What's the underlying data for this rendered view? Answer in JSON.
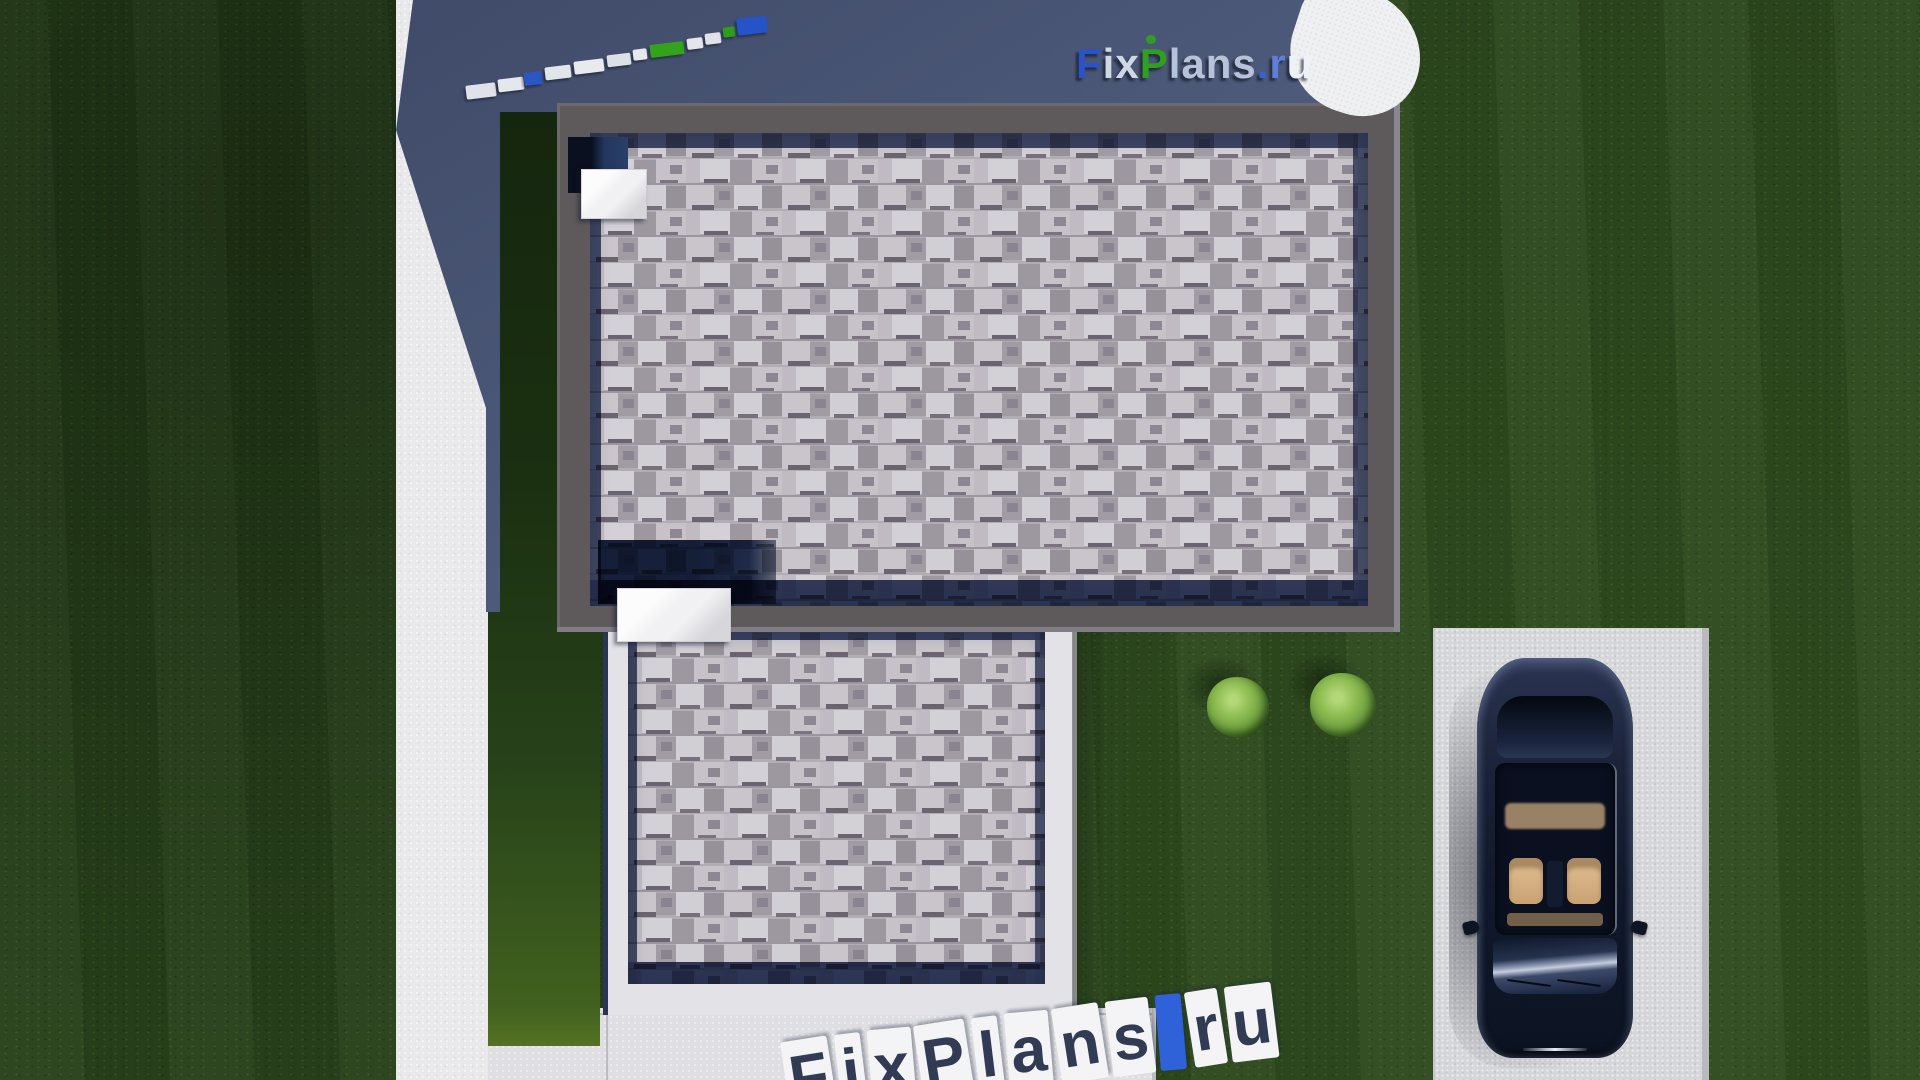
{
  "brand": "FixPlans.ru",
  "watermarks": {
    "logo_top_right": {
      "text": "FixPlans.ru",
      "letters": [
        {
          "ch": "F",
          "color": "#2b53c6"
        },
        {
          "ch": "i",
          "color": "#cfd6e4"
        },
        {
          "ch": "x",
          "color": "#cfd6e4"
        },
        {
          "ch": "P",
          "color": "#2f9e21"
        },
        {
          "ch": "l",
          "color": "#b6c1da"
        },
        {
          "ch": "a",
          "color": "#b6c1da"
        },
        {
          "ch": "n",
          "color": "#b6c1da"
        },
        {
          "ch": "s",
          "color": "#b6c1da"
        },
        {
          "ch": ".",
          "color": "#3a62cf"
        },
        {
          "ch": "r",
          "color": "#5e7ed8"
        },
        {
          "ch": "u",
          "color": "#eef1f7"
        }
      ],
      "accent_dot_color": "#2f9e21",
      "splash_color": "#eef0f1"
    },
    "stamp_bottom": {
      "text": "FixPlans.ru",
      "chip_color": "#f4f4f6",
      "text_color": "#323b54",
      "dot_color": "#2f62d8",
      "angle_deg": -7
    },
    "stone_logo_walkway": {
      "note": "brand logo rendered as stepping stones on shadowed terrace",
      "stones": [
        {
          "x": 466,
          "y": 84,
          "w": 30,
          "h": 14,
          "color": "#dfe2e8"
        },
        {
          "x": 498,
          "y": 78,
          "w": 26,
          "h": 13,
          "color": "#e4e7ec"
        },
        {
          "x": 524,
          "y": 72,
          "w": 18,
          "h": 13,
          "color": "#2b56c4"
        },
        {
          "x": 545,
          "y": 66,
          "w": 26,
          "h": 13,
          "color": "#e2e5ea"
        },
        {
          "x": 574,
          "y": 60,
          "w": 30,
          "h": 13,
          "color": "#e8eaee"
        },
        {
          "x": 607,
          "y": 54,
          "w": 24,
          "h": 12,
          "color": "#dde0e6"
        },
        {
          "x": 633,
          "y": 49,
          "w": 14,
          "h": 11,
          "color": "#e6e8ec"
        },
        {
          "x": 650,
          "y": 43,
          "w": 34,
          "h": 13,
          "color": "#33a31e"
        },
        {
          "x": 687,
          "y": 38,
          "w": 16,
          "h": 11,
          "color": "#e3e6ea"
        },
        {
          "x": 705,
          "y": 33,
          "w": 16,
          "h": 11,
          "color": "#dfe2e8"
        },
        {
          "x": 723,
          "y": 27,
          "w": 12,
          "h": 10,
          "color": "#2f9c1c"
        },
        {
          "x": 737,
          "y": 17,
          "w": 30,
          "h": 17,
          "color": "#2553c8"
        }
      ]
    }
  },
  "scene": {
    "view": "top-down 3D render of flat-roof house plot",
    "grass_color": "#2a451c",
    "shadow_color_start": "#3f4b68",
    "shadow_color_end": "#5a6789",
    "driveway_color": "#e9e9ec",
    "patio_color": "#dfdfe3",
    "parking_pad_color": "#d5d6d9",
    "roof_parapet_color": "#5e5a5c",
    "lower_parapet_color": "#e3e3e7",
    "shingle_base_color": "#b2adb4",
    "shadow_band_color": "#34405e",
    "car": {
      "type": "sedan-top-view",
      "body_color": "#141c2e",
      "interior_color": "#d8b488"
    },
    "bushes": [
      {
        "x": 1237,
        "y": 707,
        "d": 60
      },
      {
        "x": 1342,
        "y": 705,
        "d": 64
      }
    ]
  }
}
